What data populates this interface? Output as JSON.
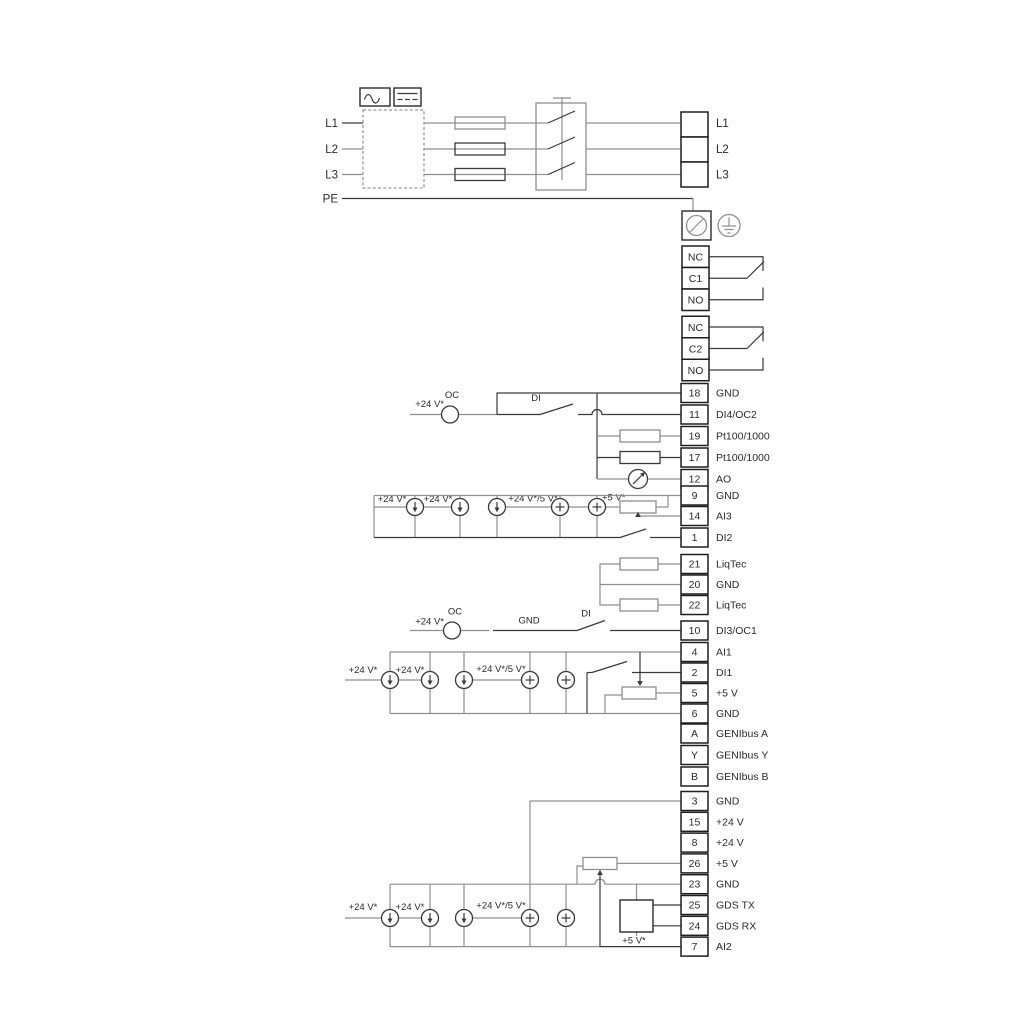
{
  "colors": {
    "background": "#ffffff",
    "wire_grey": "#8f8f8f",
    "wire_dark": "#3a3a3a",
    "text": "#2b2b2b"
  },
  "power": {
    "left_labels": [
      "L1",
      "L2",
      "L3",
      "PE"
    ],
    "right_labels": [
      "L1",
      "L2",
      "L3"
    ]
  },
  "relays": {
    "relay1": [
      "NC",
      "C1",
      "NO"
    ],
    "relay2": [
      "NC",
      "C2",
      "NO"
    ]
  },
  "io": {
    "rows": [
      {
        "num": "18",
        "label": "GND"
      },
      {
        "num": "11",
        "label": "DI4/OC2"
      },
      {
        "num": "19",
        "label": "Pt100/1000"
      },
      {
        "num": "17",
        "label": "Pt100/1000"
      },
      {
        "num": "12",
        "label": "AO"
      },
      {
        "num": "9",
        "label": "GND"
      },
      {
        "num": "14",
        "label": "AI3"
      },
      {
        "num": "1",
        "label": "DI2"
      },
      {
        "num": "21",
        "label": "LiqTec"
      },
      {
        "num": "20",
        "label": "GND"
      },
      {
        "num": "22",
        "label": "LiqTec"
      },
      {
        "num": "10",
        "label": "DI3/OC1"
      },
      {
        "num": "4",
        "label": "AI1"
      },
      {
        "num": "2",
        "label": "DI1"
      },
      {
        "num": "5",
        "label": "+5 V"
      },
      {
        "num": "6",
        "label": "GND"
      },
      {
        "num": "A",
        "label": "GENIbus A"
      },
      {
        "num": "Y",
        "label": "GENIbus Y"
      },
      {
        "num": "B",
        "label": "GENIbus B"
      },
      {
        "num": "3",
        "label": "GND"
      },
      {
        "num": "15",
        "label": "+24 V"
      },
      {
        "num": "8",
        "label": "+24 V"
      },
      {
        "num": "26",
        "label": "+5 V"
      },
      {
        "num": "23",
        "label": "GND"
      },
      {
        "num": "25",
        "label": "GDS TX"
      },
      {
        "num": "24",
        "label": "GDS RX"
      },
      {
        "num": "7",
        "label": "AI2"
      }
    ]
  },
  "annotations": {
    "plus24": "+24 V*",
    "oc": "OC",
    "di": "DI",
    "gnd": "GND",
    "plus24_5": "+24 V*/5 V*",
    "plus5": "+5 V*"
  },
  "icons": {
    "ac": "sine-wave-icon",
    "dc": "dc-dashes-icon",
    "screw_terminal": "screw-terminal-icon",
    "earth": "earth-ground-icon",
    "current_source": "current-source-icon",
    "voltage_source": "plus-source-icon",
    "meter": "analog-meter-icon"
  }
}
